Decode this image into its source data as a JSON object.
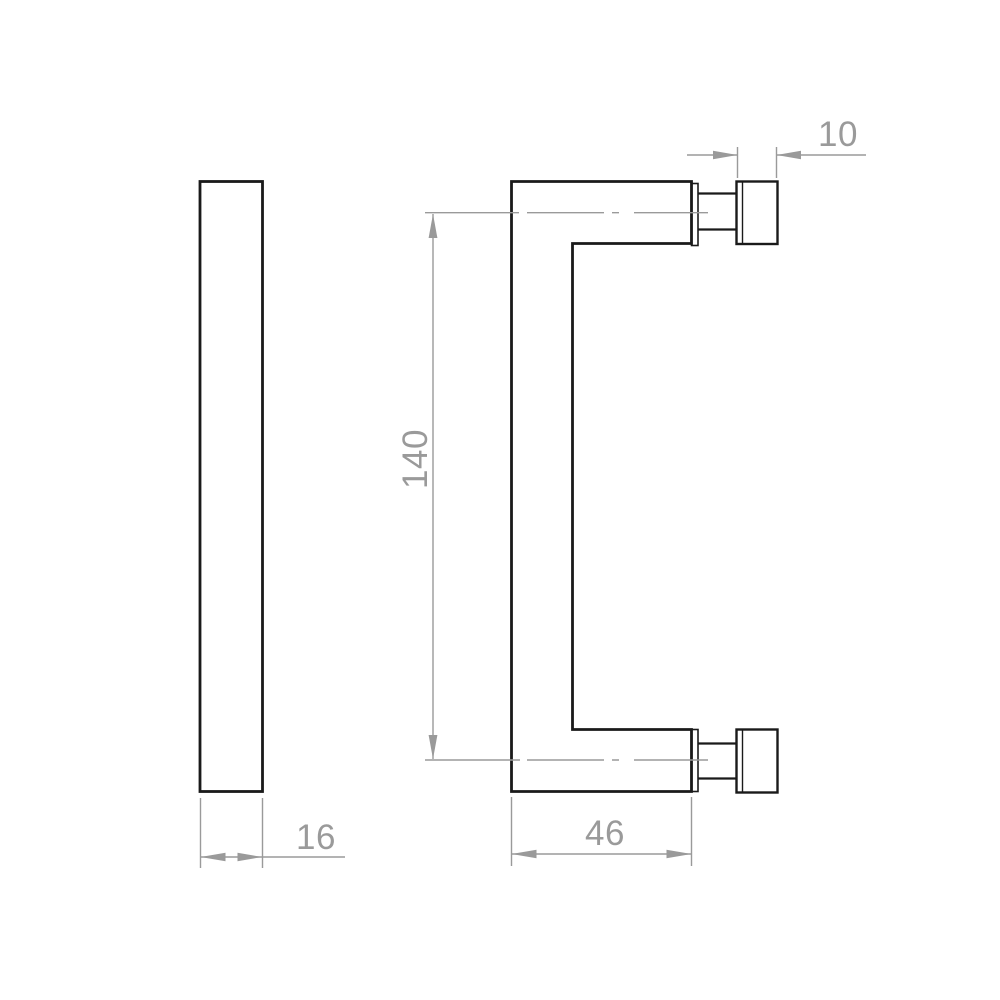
{
  "drawing": {
    "dimensions": {
      "overall_height": "140",
      "projection_depth": "46",
      "bar_width": "16",
      "fixing_head_width": "10"
    },
    "colors": {
      "outline": "#1a1a1a",
      "dimension": "#9a9a9a",
      "background": "#ffffff"
    }
  }
}
